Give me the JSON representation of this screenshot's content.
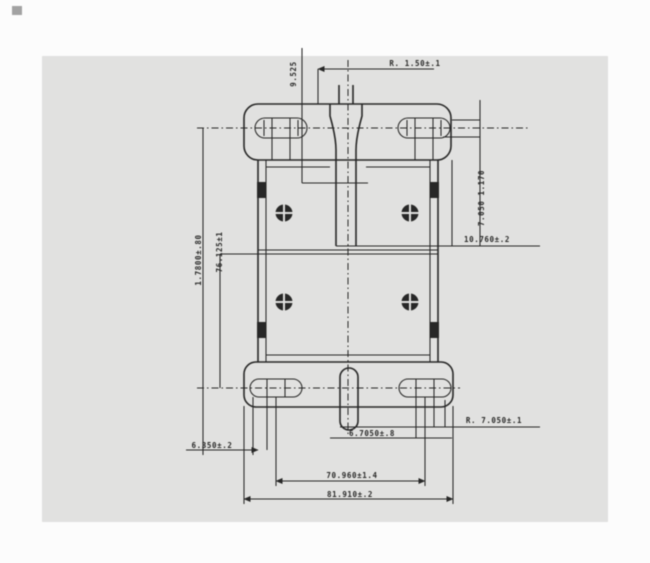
{
  "colors": {
    "ink": "#1f1f1f",
    "paper": "#eaeae8",
    "page": "#fcfcfc"
  },
  "labels": {
    "top_vertical": "9.525",
    "top_right": "R. 1.50±.1",
    "right_vertical": "7.050 1.170",
    "right_mid": "10.760±.2",
    "left_outer_vertical": "1.7800±.80",
    "left_inner_vertical": "76.125±1",
    "bottom_right": "R. 7.050±.1",
    "bottom_center": "6.7050±.8",
    "bottom_left": "6.350±.2",
    "bottom_width_inner": "70.960±1.4",
    "bottom_width_outer": "81.910±.2"
  }
}
